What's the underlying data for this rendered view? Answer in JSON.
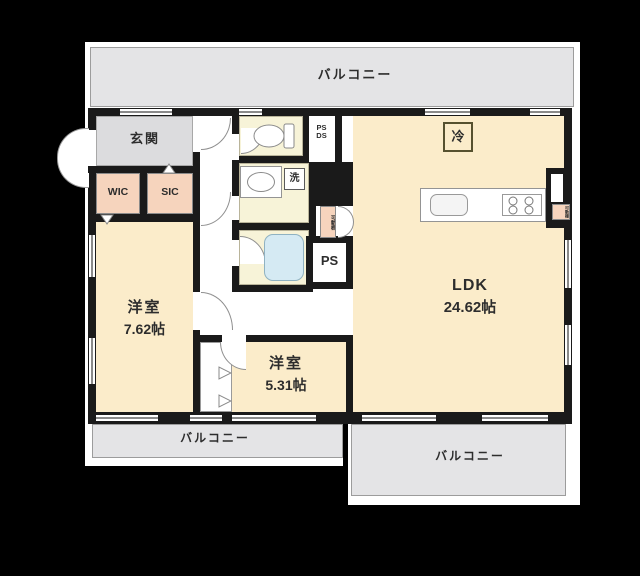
{
  "colors": {
    "background": "#000000",
    "sheet": "#ffffff",
    "wall": "#1a1a1a",
    "balcony_fill": "#e4e4e6",
    "genkan_fill": "#dcdcde",
    "room_fill": "#fbecca",
    "bath_fill": "#f7f3d8",
    "closet_fill": "#f6d4bd",
    "tub_fill": "#d5eaf3",
    "text": "#2d2d2d"
  },
  "labels": {
    "balcony_top": "バルコニー",
    "balcony_bottom_left": "バルコニー",
    "balcony_bottom_right": "バルコニー",
    "genkan": "玄関",
    "wic": "WIC",
    "sic": "SIC",
    "bedroom1_name": "洋室",
    "bedroom1_size": "7.62帖",
    "bedroom2_name": "洋室",
    "bedroom2_size": "5.31帖",
    "ldk_name": "LDK",
    "ldk_size": "24.62帖",
    "ps": "PS",
    "ps_duct_line1": "PS",
    "ps_duct_line2": "DS",
    "laundry": "洗",
    "fridge": "冷",
    "movable_shelf": "可動棚",
    "kitchen_shelf": "可動棚"
  }
}
